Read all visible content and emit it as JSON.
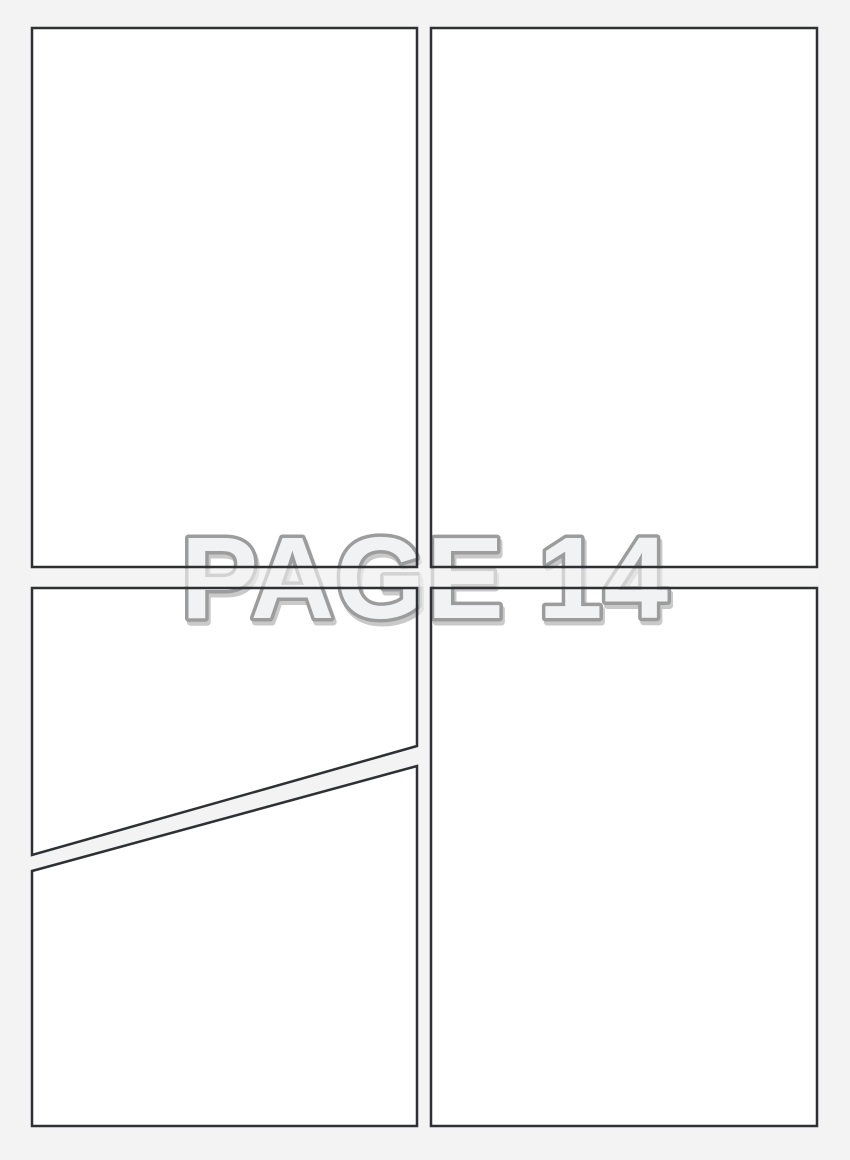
{
  "watermark": {
    "text": "PAGE 14"
  },
  "colors": {
    "page_bg": "#f3f3f4",
    "panel_fill": "#ffffff",
    "border": "#2e3033",
    "watermark_fill": "#f1f2f3",
    "watermark_stroke": "#9c9c9c",
    "watermark_shadow": "#c9c9c9"
  }
}
